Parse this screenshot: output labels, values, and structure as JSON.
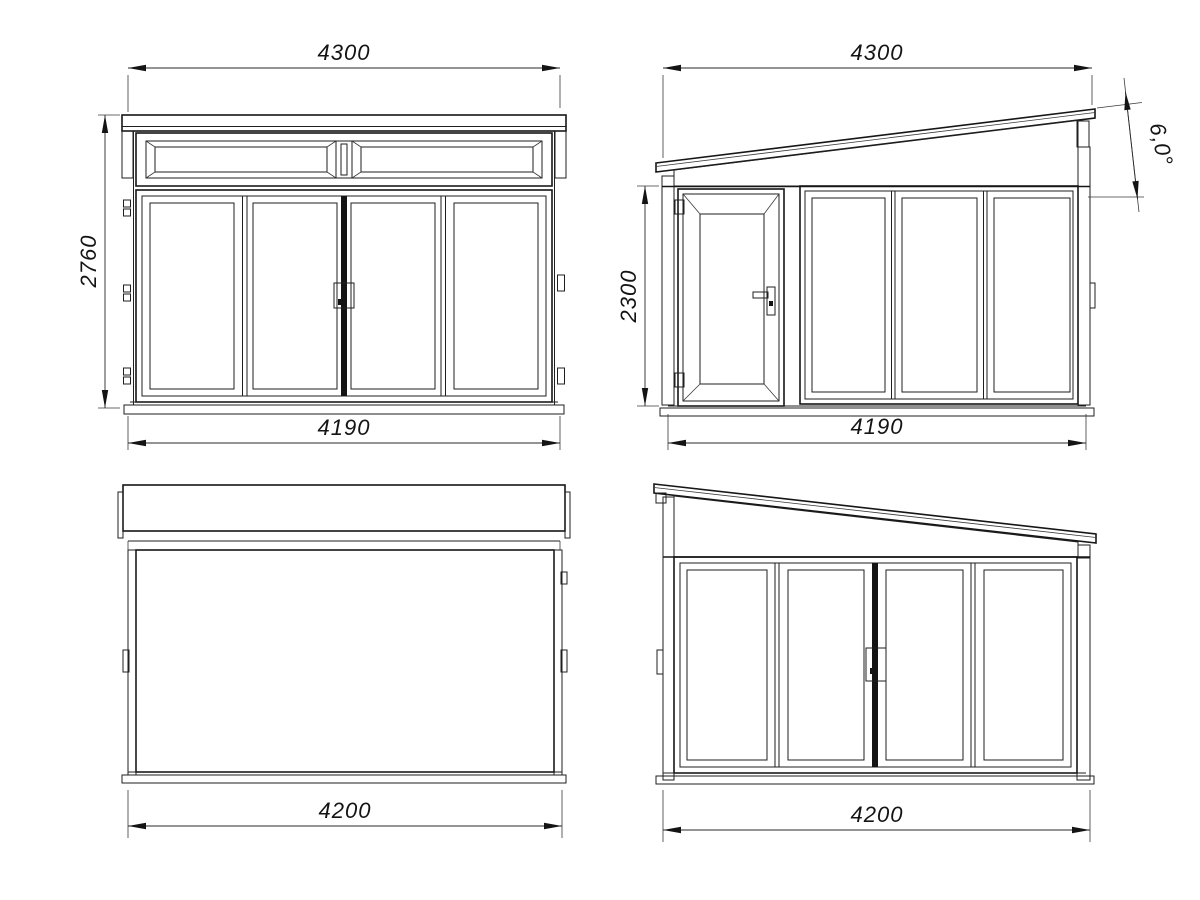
{
  "drawing": {
    "line_color": "#1c1c1c",
    "background_color": "#ffffff",
    "views": {
      "front": {
        "dims": {
          "roof_width": "4300",
          "height": "2760",
          "wall_width": "4190"
        }
      },
      "side_entry": {
        "dims": {
          "roof_width": "4300",
          "roof_angle": "6,0°",
          "wall_height": "2300",
          "wall_width": "4190"
        }
      },
      "rear": {
        "dims": {
          "wall_width": "4200"
        }
      },
      "side_glazed": {
        "dims": {
          "wall_width": "4200"
        }
      }
    }
  }
}
